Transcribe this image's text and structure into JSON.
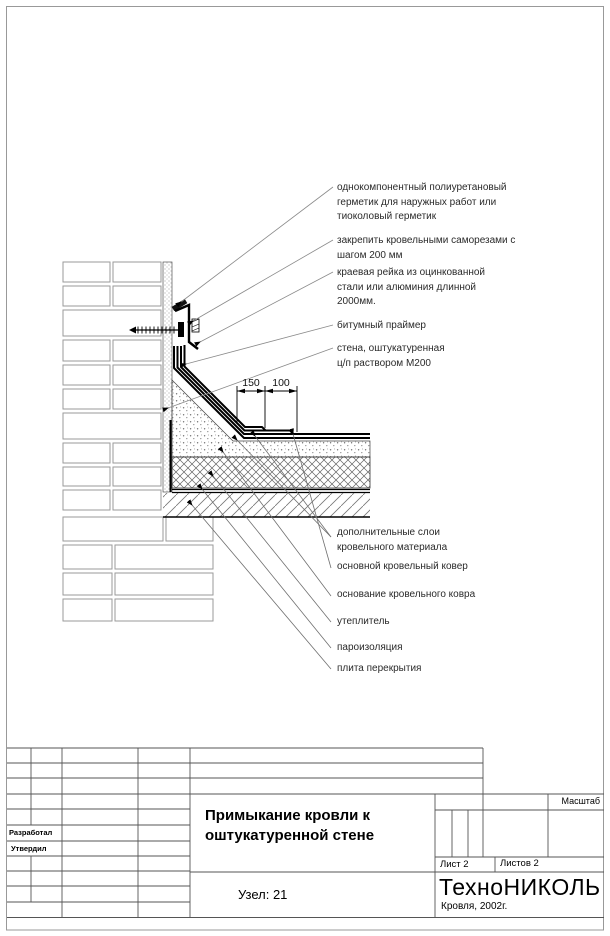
{
  "annotations": {
    "sealant": "однокомпонентный  полиуретановый\nгерметик  для наружных работ  или\nтиоколовый герметик",
    "fastening": "закрепить кровельными саморезами с\nшагом 200 мм",
    "edge_rail": "краевая рейка из оцинкованной\nстали или алюминия длинной\n2000мм.",
    "bitumen_primer": "битумный праймер",
    "wall": "стена, оштукатуренная\nц/п раствором М200",
    "additional_layers": "дополнительные слои\nкровельного материала",
    "main_carpet": "основной кровельный ковер",
    "carpet_base": "основание кровельного ковра",
    "insulation": "утеплитель",
    "vapor_barrier": "пароизоляция",
    "slab": "плита перекрытия"
  },
  "dimensions": {
    "d1": "150",
    "d2": "100"
  },
  "title_block": {
    "developed_label": "Разработал",
    "approved_label": "Утвердил",
    "title": "Примыкание кровли к\nоштукатуренной стене",
    "node": "Узел: 21",
    "scale_label": "Масштаб",
    "sheet": "Лист 2",
    "sheets": "Листов 2",
    "brand": "ТехноНИКОЛЬ",
    "brand_sub": "Кровля, 2002г."
  }
}
